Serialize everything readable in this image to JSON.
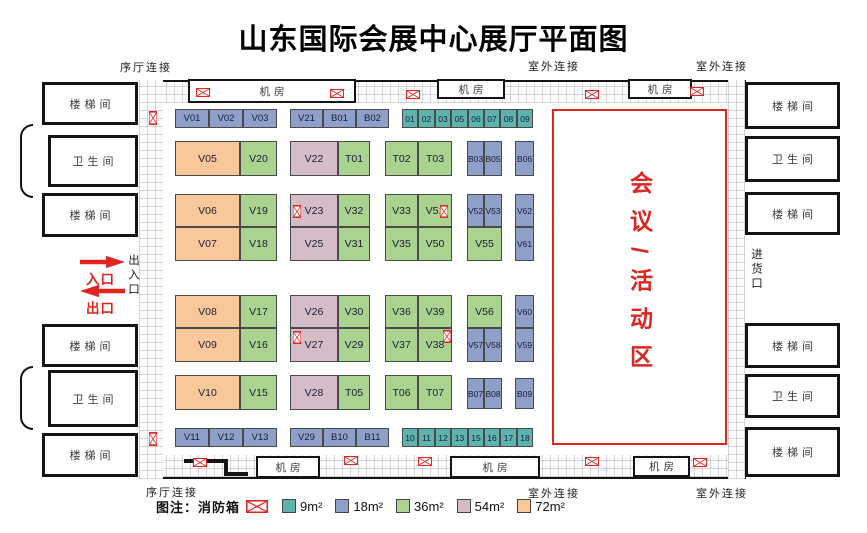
{
  "title": "山东国际会展中心展厅平面图",
  "colors": {
    "9": "#5db3ad",
    "18": "#8e9fca",
    "36": "#a9d38f",
    "54": "#d5bcc9",
    "72": "#f8c89b",
    "accent_red": "#e0251f"
  },
  "outer_labels": [
    {
      "text": "序厅连接",
      "x": 120,
      "y": 59
    },
    {
      "text": "室外连接",
      "x": 528,
      "y": 58
    },
    {
      "text": "室外连接",
      "x": 696,
      "y": 58
    },
    {
      "text": "序厅连接",
      "x": 146,
      "y": 484
    },
    {
      "text": "室外连接",
      "x": 528,
      "y": 485
    },
    {
      "text": "室外连接",
      "x": 696,
      "y": 485
    }
  ],
  "machine_rooms": [
    {
      "label": "机房",
      "x": 188,
      "y": 79,
      "w": 168,
      "h": 24
    },
    {
      "label": "机房",
      "x": 437,
      "y": 79,
      "w": 68,
      "h": 20
    },
    {
      "label": "机房",
      "x": 628,
      "y": 79,
      "w": 64,
      "h": 20
    },
    {
      "label": "机房",
      "x": 256,
      "y": 456,
      "w": 64,
      "h": 22
    },
    {
      "label": "机房",
      "x": 450,
      "y": 456,
      "w": 90,
      "h": 22
    },
    {
      "label": "机房",
      "x": 633,
      "y": 456,
      "w": 57,
      "h": 21
    }
  ],
  "side_rooms": [
    {
      "label": "楼梯间",
      "type": "stairwell",
      "x": 42,
      "y": 82,
      "w": 96,
      "h": 43
    },
    {
      "label": "卫生间",
      "type": "restroom",
      "x": 48,
      "y": 135,
      "w": 90,
      "h": 52
    },
    {
      "label": "楼梯间",
      "type": "stairwell",
      "x": 42,
      "y": 193,
      "w": 96,
      "h": 44
    },
    {
      "label": "楼梯间",
      "type": "stairwell",
      "x": 42,
      "y": 324,
      "w": 96,
      "h": 43
    },
    {
      "label": "卫生间",
      "type": "restroom",
      "x": 48,
      "y": 370,
      "w": 90,
      "h": 57
    },
    {
      "label": "楼梯间",
      "type": "stairwell",
      "x": 42,
      "y": 433,
      "w": 96,
      "h": 44
    },
    {
      "label": "楼梯间",
      "type": "stairwell",
      "x": 745,
      "y": 82,
      "w": 95,
      "h": 47
    },
    {
      "label": "卫生间",
      "type": "restroom",
      "x": 745,
      "y": 136,
      "w": 95,
      "h": 46
    },
    {
      "label": "楼梯间",
      "type": "stairwell",
      "x": 745,
      "y": 192,
      "w": 95,
      "h": 43
    },
    {
      "label": "楼梯间",
      "type": "stairwell",
      "x": 745,
      "y": 323,
      "w": 95,
      "h": 45
    },
    {
      "label": "卫生间",
      "type": "restroom",
      "x": 745,
      "y": 374,
      "w": 95,
      "h": 44
    },
    {
      "label": "楼梯间",
      "type": "stairwell",
      "x": 745,
      "y": 427,
      "w": 95,
      "h": 50
    }
  ],
  "entrance": {
    "in_label": "入口",
    "out_label": "出口",
    "side_label": "出入口",
    "goods_label": "进货口"
  },
  "conference": {
    "label": "会议/活动区"
  },
  "legend": {
    "title": "图注：",
    "fire_label": "消防箱",
    "items": [
      {
        "label": "9m²",
        "size": "9"
      },
      {
        "label": "18m²",
        "size": "18"
      },
      {
        "label": "36m²",
        "size": "36"
      },
      {
        "label": "54m²",
        "size": "54"
      },
      {
        "label": "72m²",
        "size": "72"
      }
    ]
  },
  "booths": [
    {
      "id": "V01",
      "x": 175,
      "y": 109,
      "w": 34,
      "h": 19,
      "s": "18"
    },
    {
      "id": "V02",
      "x": 209,
      "y": 109,
      "w": 34,
      "h": 19,
      "s": "18"
    },
    {
      "id": "V03",
      "x": 243,
      "y": 109,
      "w": 34,
      "h": 19,
      "s": "18"
    },
    {
      "id": "V21",
      "x": 290,
      "y": 109,
      "w": 33,
      "h": 19,
      "s": "18"
    },
    {
      "id": "B01",
      "x": 323,
      "y": 109,
      "w": 33,
      "h": 19,
      "s": "18"
    },
    {
      "id": "B02",
      "x": 356,
      "y": 109,
      "w": 33,
      "h": 19,
      "s": "18"
    },
    {
      "id": "01",
      "x": 402,
      "y": 109,
      "w": 16,
      "h": 19,
      "s": "9"
    },
    {
      "id": "02",
      "x": 418,
      "y": 109,
      "w": 17,
      "h": 19,
      "s": "9"
    },
    {
      "id": "03",
      "x": 435,
      "y": 109,
      "w": 16,
      "h": 19,
      "s": "9"
    },
    {
      "id": "05",
      "x": 451,
      "y": 109,
      "w": 17,
      "h": 19,
      "s": "9"
    },
    {
      "id": "06",
      "x": 468,
      "y": 109,
      "w": 16,
      "h": 19,
      "s": "9"
    },
    {
      "id": "07",
      "x": 484,
      "y": 109,
      "w": 16,
      "h": 19,
      "s": "9"
    },
    {
      "id": "08",
      "x": 500,
      "y": 109,
      "w": 17,
      "h": 19,
      "s": "9"
    },
    {
      "id": "09",
      "x": 517,
      "y": 109,
      "w": 16,
      "h": 19,
      "s": "9"
    },
    {
      "id": "V05",
      "x": 175,
      "y": 141,
      "w": 65,
      "h": 35,
      "s": "72"
    },
    {
      "id": "V20",
      "x": 240,
      "y": 141,
      "w": 37,
      "h": 35,
      "s": "36"
    },
    {
      "id": "V22",
      "x": 290,
      "y": 141,
      "w": 48,
      "h": 35,
      "s": "54"
    },
    {
      "id": "T01",
      "x": 338,
      "y": 141,
      "w": 32,
      "h": 35,
      "s": "36"
    },
    {
      "id": "T02",
      "x": 385,
      "y": 141,
      "w": 33,
      "h": 35,
      "s": "36"
    },
    {
      "id": "T03",
      "x": 418,
      "y": 141,
      "w": 34,
      "h": 35,
      "s": "36"
    },
    {
      "id": "B03",
      "x": 467,
      "y": 141,
      "w": 17,
      "h": 35,
      "s": "18"
    },
    {
      "id": "B05",
      "x": 484,
      "y": 141,
      "w": 18,
      "h": 35,
      "s": "18"
    },
    {
      "id": "B06",
      "x": 515,
      "y": 141,
      "w": 19,
      "h": 35,
      "s": "18"
    },
    {
      "id": "V06",
      "x": 175,
      "y": 194,
      "w": 65,
      "h": 33,
      "s": "72"
    },
    {
      "id": "V19",
      "x": 240,
      "y": 194,
      "w": 37,
      "h": 33,
      "s": "36"
    },
    {
      "id": "V23",
      "x": 290,
      "y": 194,
      "w": 48,
      "h": 33,
      "s": "54"
    },
    {
      "id": "V32",
      "x": 338,
      "y": 194,
      "w": 32,
      "h": 33,
      "s": "36"
    },
    {
      "id": "V33",
      "x": 385,
      "y": 194,
      "w": 33,
      "h": 33,
      "s": "36"
    },
    {
      "id": "V51",
      "x": 418,
      "y": 194,
      "w": 34,
      "h": 33,
      "s": "36"
    },
    {
      "id": "V52",
      "x": 467,
      "y": 194,
      "w": 17,
      "h": 33,
      "s": "18"
    },
    {
      "id": "V53",
      "x": 484,
      "y": 194,
      "w": 18,
      "h": 33,
      "s": "18"
    },
    {
      "id": "V62",
      "x": 515,
      "y": 194,
      "w": 19,
      "h": 33,
      "s": "18"
    },
    {
      "id": "V07",
      "x": 175,
      "y": 227,
      "w": 65,
      "h": 34,
      "s": "72"
    },
    {
      "id": "V18",
      "x": 240,
      "y": 227,
      "w": 37,
      "h": 34,
      "s": "36"
    },
    {
      "id": "V25",
      "x": 290,
      "y": 227,
      "w": 48,
      "h": 34,
      "s": "54"
    },
    {
      "id": "V31",
      "x": 338,
      "y": 227,
      "w": 32,
      "h": 34,
      "s": "36"
    },
    {
      "id": "V35",
      "x": 385,
      "y": 227,
      "w": 33,
      "h": 34,
      "s": "36"
    },
    {
      "id": "V50",
      "x": 418,
      "y": 227,
      "w": 34,
      "h": 34,
      "s": "36"
    },
    {
      "id": "V55",
      "x": 467,
      "y": 227,
      "w": 35,
      "h": 34,
      "s": "36"
    },
    {
      "id": "V61",
      "x": 515,
      "y": 227,
      "w": 19,
      "h": 34,
      "s": "18"
    },
    {
      "id": "V08",
      "x": 175,
      "y": 295,
      "w": 65,
      "h": 33,
      "s": "72"
    },
    {
      "id": "V17",
      "x": 240,
      "y": 295,
      "w": 37,
      "h": 33,
      "s": "36"
    },
    {
      "id": "V26",
      "x": 290,
      "y": 295,
      "w": 48,
      "h": 33,
      "s": "54"
    },
    {
      "id": "V30",
      "x": 338,
      "y": 295,
      "w": 32,
      "h": 33,
      "s": "36"
    },
    {
      "id": "V36",
      "x": 385,
      "y": 295,
      "w": 33,
      "h": 33,
      "s": "36"
    },
    {
      "id": "V39",
      "x": 418,
      "y": 295,
      "w": 34,
      "h": 33,
      "s": "36"
    },
    {
      "id": "V56",
      "x": 467,
      "y": 295,
      "w": 35,
      "h": 33,
      "s": "36"
    },
    {
      "id": "V60",
      "x": 515,
      "y": 295,
      "w": 19,
      "h": 33,
      "s": "18"
    },
    {
      "id": "V09",
      "x": 175,
      "y": 328,
      "w": 65,
      "h": 34,
      "s": "72"
    },
    {
      "id": "V16",
      "x": 240,
      "y": 328,
      "w": 37,
      "h": 34,
      "s": "36"
    },
    {
      "id": "V27",
      "x": 290,
      "y": 328,
      "w": 48,
      "h": 34,
      "s": "54"
    },
    {
      "id": "V29",
      "x": 338,
      "y": 328,
      "w": 32,
      "h": 34,
      "s": "36"
    },
    {
      "id": "V37",
      "x": 385,
      "y": 328,
      "w": 33,
      "h": 34,
      "s": "36"
    },
    {
      "id": "V38",
      "x": 418,
      "y": 328,
      "w": 34,
      "h": 34,
      "s": "36"
    },
    {
      "id": "V57",
      "x": 467,
      "y": 328,
      "w": 17,
      "h": 34,
      "s": "18"
    },
    {
      "id": "V58",
      "x": 484,
      "y": 328,
      "w": 18,
      "h": 34,
      "s": "18"
    },
    {
      "id": "V59",
      "x": 515,
      "y": 328,
      "w": 19,
      "h": 34,
      "s": "18"
    },
    {
      "id": "V10",
      "x": 175,
      "y": 375,
      "w": 65,
      "h": 35,
      "s": "72"
    },
    {
      "id": "V15",
      "x": 240,
      "y": 375,
      "w": 37,
      "h": 35,
      "s": "36"
    },
    {
      "id": "V28",
      "x": 290,
      "y": 375,
      "w": 48,
      "h": 35,
      "s": "54"
    },
    {
      "id": "T05",
      "x": 338,
      "y": 375,
      "w": 32,
      "h": 35,
      "s": "36"
    },
    {
      "id": "T06",
      "x": 385,
      "y": 375,
      "w": 33,
      "h": 35,
      "s": "36"
    },
    {
      "id": "T07",
      "x": 418,
      "y": 375,
      "w": 34,
      "h": 35,
      "s": "36"
    },
    {
      "id": "B07",
      "x": 467,
      "y": 378,
      "w": 17,
      "h": 31,
      "s": "18"
    },
    {
      "id": "B08",
      "x": 484,
      "y": 378,
      "w": 18,
      "h": 31,
      "s": "18"
    },
    {
      "id": "B09",
      "x": 515,
      "y": 378,
      "w": 19,
      "h": 31,
      "s": "18"
    },
    {
      "id": "V11",
      "x": 175,
      "y": 428,
      "w": 34,
      "h": 19,
      "s": "18"
    },
    {
      "id": "V12",
      "x": 209,
      "y": 428,
      "w": 34,
      "h": 19,
      "s": "18"
    },
    {
      "id": "V13",
      "x": 243,
      "y": 428,
      "w": 34,
      "h": 19,
      "s": "18"
    },
    {
      "id": "V29",
      "x": 290,
      "y": 428,
      "w": 33,
      "h": 19,
      "s": "18"
    },
    {
      "id": "B10",
      "x": 323,
      "y": 428,
      "w": 33,
      "h": 19,
      "s": "18"
    },
    {
      "id": "B11",
      "x": 356,
      "y": 428,
      "w": 33,
      "h": 19,
      "s": "18"
    },
    {
      "id": "10",
      "x": 402,
      "y": 428,
      "w": 16,
      "h": 19,
      "s": "9"
    },
    {
      "id": "11",
      "x": 418,
      "y": 428,
      "w": 17,
      "h": 19,
      "s": "9"
    },
    {
      "id": "12",
      "x": 435,
      "y": 428,
      "w": 16,
      "h": 19,
      "s": "9"
    },
    {
      "id": "13",
      "x": 451,
      "y": 428,
      "w": 17,
      "h": 19,
      "s": "9"
    },
    {
      "id": "15",
      "x": 468,
      "y": 428,
      "w": 16,
      "h": 19,
      "s": "9"
    },
    {
      "id": "16",
      "x": 484,
      "y": 428,
      "w": 16,
      "h": 19,
      "s": "9"
    },
    {
      "id": "17",
      "x": 500,
      "y": 428,
      "w": 17,
      "h": 19,
      "s": "9"
    },
    {
      "id": "18",
      "x": 517,
      "y": 428,
      "w": 16,
      "h": 19,
      "s": "9"
    }
  ],
  "fire_boxes": [
    {
      "x": 196,
      "y": 88,
      "w": 14,
      "h": 9
    },
    {
      "x": 330,
      "y": 89,
      "w": 14,
      "h": 9
    },
    {
      "x": 406,
      "y": 90,
      "w": 14,
      "h": 9
    },
    {
      "x": 585,
      "y": 90,
      "w": 14,
      "h": 9
    },
    {
      "x": 690,
      "y": 87,
      "w": 14,
      "h": 9
    },
    {
      "x": 193,
      "y": 458,
      "w": 14,
      "h": 9
    },
    {
      "x": 344,
      "y": 456,
      "w": 14,
      "h": 9
    },
    {
      "x": 418,
      "y": 457,
      "w": 14,
      "h": 9
    },
    {
      "x": 585,
      "y": 457,
      "w": 14,
      "h": 9
    },
    {
      "x": 693,
      "y": 458,
      "w": 14,
      "h": 9
    },
    {
      "x": 149,
      "y": 111,
      "w": 8,
      "h": 14
    },
    {
      "x": 149,
      "y": 432,
      "w": 8,
      "h": 14
    },
    {
      "x": 293,
      "y": 205,
      "w": 8,
      "h": 13
    },
    {
      "x": 440,
      "y": 205,
      "w": 8,
      "h": 13
    },
    {
      "x": 293,
      "y": 331,
      "w": 8,
      "h": 13
    },
    {
      "x": 443,
      "y": 330,
      "w": 8,
      "h": 13
    }
  ]
}
